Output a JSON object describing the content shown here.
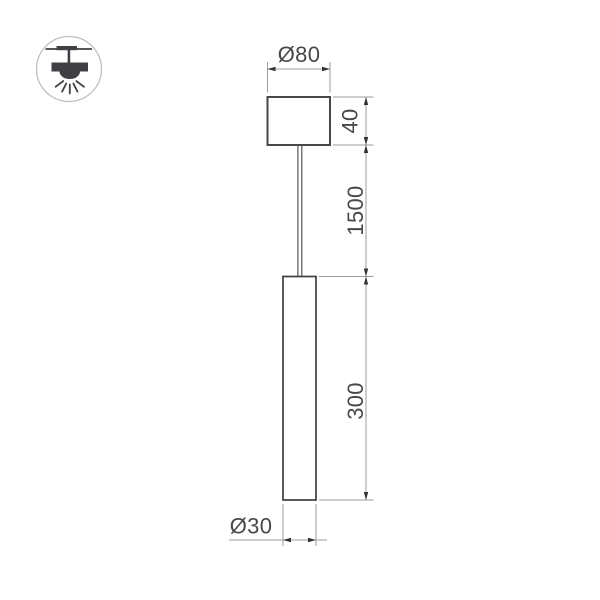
{
  "page": {
    "background": "#ffffff"
  },
  "icon": {
    "name": "ceiling-pendant-light",
    "circle_color": "#bdbdbf",
    "glyph_color": "#3f3f44"
  },
  "drawing": {
    "colors": {
      "outline": "#47474b",
      "wire": "#55555a",
      "dimension_line": "#9e9ea0",
      "arrow": "#323235",
      "text": "#48484c"
    },
    "dimensions": [
      {
        "id": "canopy-diameter",
        "label": "Ø80"
      },
      {
        "id": "canopy-height",
        "label": "40"
      },
      {
        "id": "suspension-length",
        "label": "1500"
      },
      {
        "id": "tube-length",
        "label": "300"
      },
      {
        "id": "tube-diameter",
        "label": "Ø30"
      }
    ]
  }
}
